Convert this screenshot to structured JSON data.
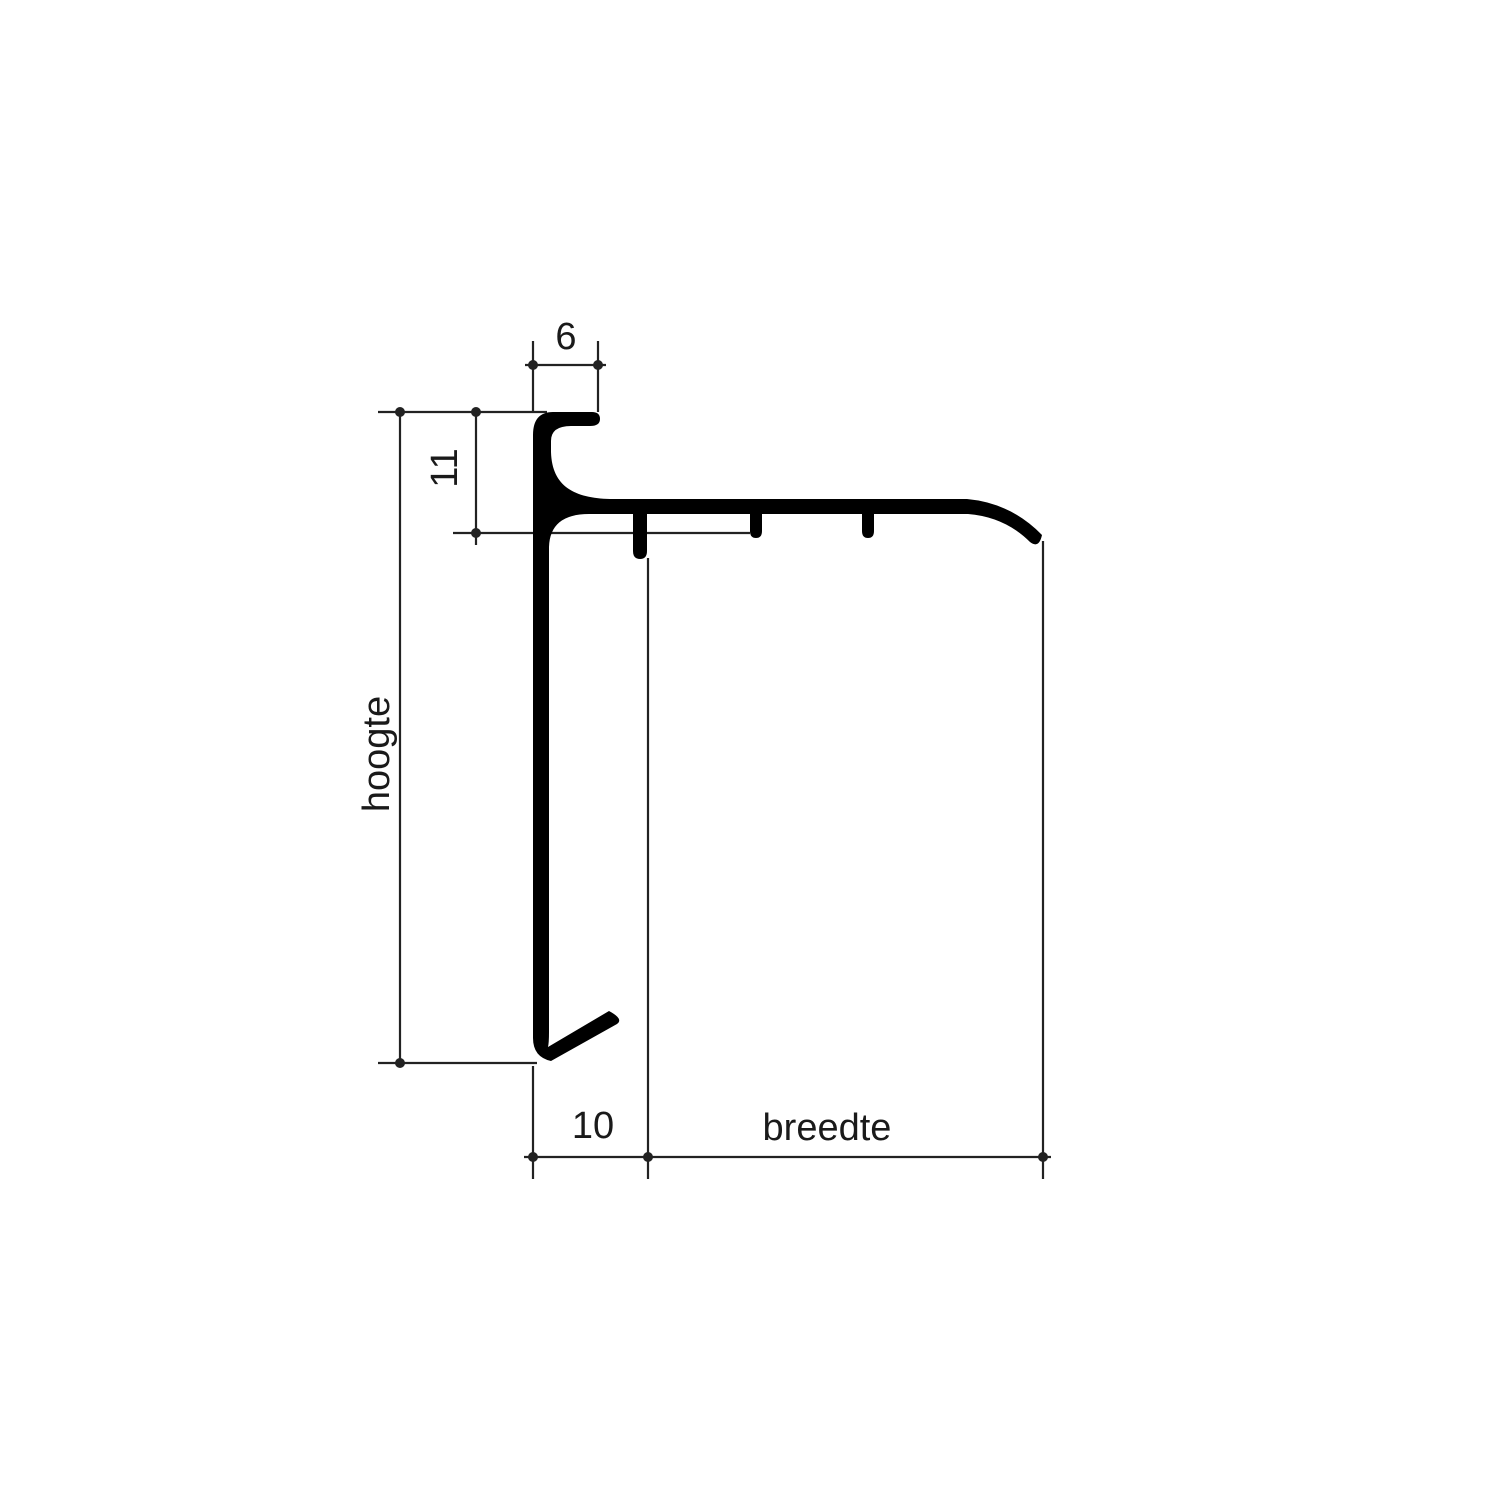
{
  "drawing": {
    "type": "profile-cross-section",
    "labels": {
      "top_width": "6",
      "upper_height": "11",
      "height": "hoogte",
      "hook_width": "10",
      "width": "breedte"
    },
    "colors": {
      "profile": "#000000",
      "dimension_line": "#222222",
      "text": "#1a1a1a",
      "background": "#ffffff"
    }
  }
}
